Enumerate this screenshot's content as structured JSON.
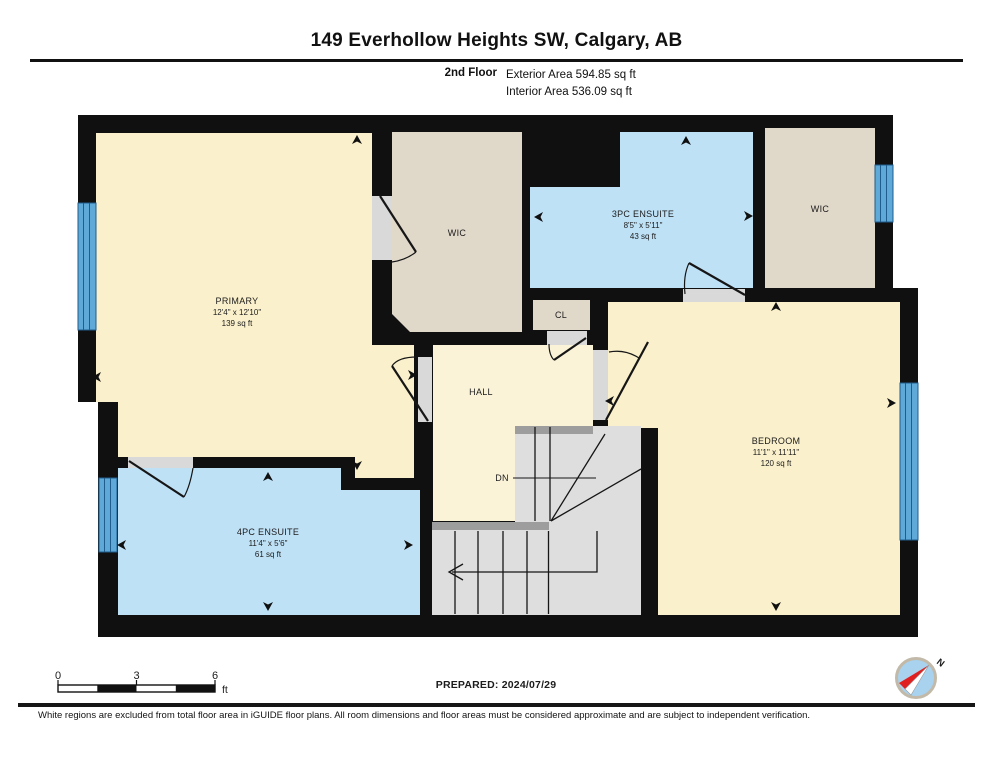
{
  "header": {
    "title": "149 Everhollow Heights SW, Calgary, AB",
    "floor_label": "2nd Floor",
    "exterior_area": "Exterior Area 594.85 sq ft",
    "interior_area": "Interior Area 536.09 sq ft"
  },
  "rooms": {
    "primary": {
      "name": "PRIMARY",
      "dims": "12'4\" x 12'10\"",
      "area": "139 sq ft"
    },
    "wic_left": {
      "name": "WIC"
    },
    "ensuite_3pc": {
      "name": "3PC ENSUITE",
      "dims": "8'5\" x 5'11\"",
      "area": "43 sq ft"
    },
    "wic_right": {
      "name": "WIC"
    },
    "closet": {
      "name": "CL"
    },
    "hall": {
      "name": "HALL"
    },
    "bedroom": {
      "name": "BEDROOM",
      "dims": "11'1\" x 11'11\"",
      "area": "120 sq ft"
    },
    "ensuite_4pc": {
      "name": "4PC ENSUITE",
      "dims": "11'4\" x 5'6\"",
      "area": "61 sq ft"
    },
    "stairs": {
      "down_label": "DN"
    }
  },
  "scale_bar": {
    "tick_0": "0",
    "tick_3": "3",
    "tick_6": "6",
    "unit": "ft"
  },
  "compass": {
    "north_label": "N"
  },
  "footer": {
    "prepared": "PREPARED: 2024/07/29",
    "disclaimer": "White regions are excluded from total floor area in iGUIDE floor plans. All room dimensions and floor areas must be considered approximate and are subject to independent verification."
  },
  "colors": {
    "wall": "#101010",
    "room_cream": "#FAF0CB",
    "room_blue": "#BFE1F6",
    "room_beige": "#E0D8C9",
    "stair_gray": "#DEDEDE",
    "stair_band": "#9D9D9D",
    "door_gray": "#D9D9D9",
    "window_blue": "#5EA9D8",
    "window_line": "#1F5D8C",
    "compass_ring": "#C2B9A8",
    "compass_fill": "#A8D2EE",
    "compass_red": "#E02020"
  }
}
